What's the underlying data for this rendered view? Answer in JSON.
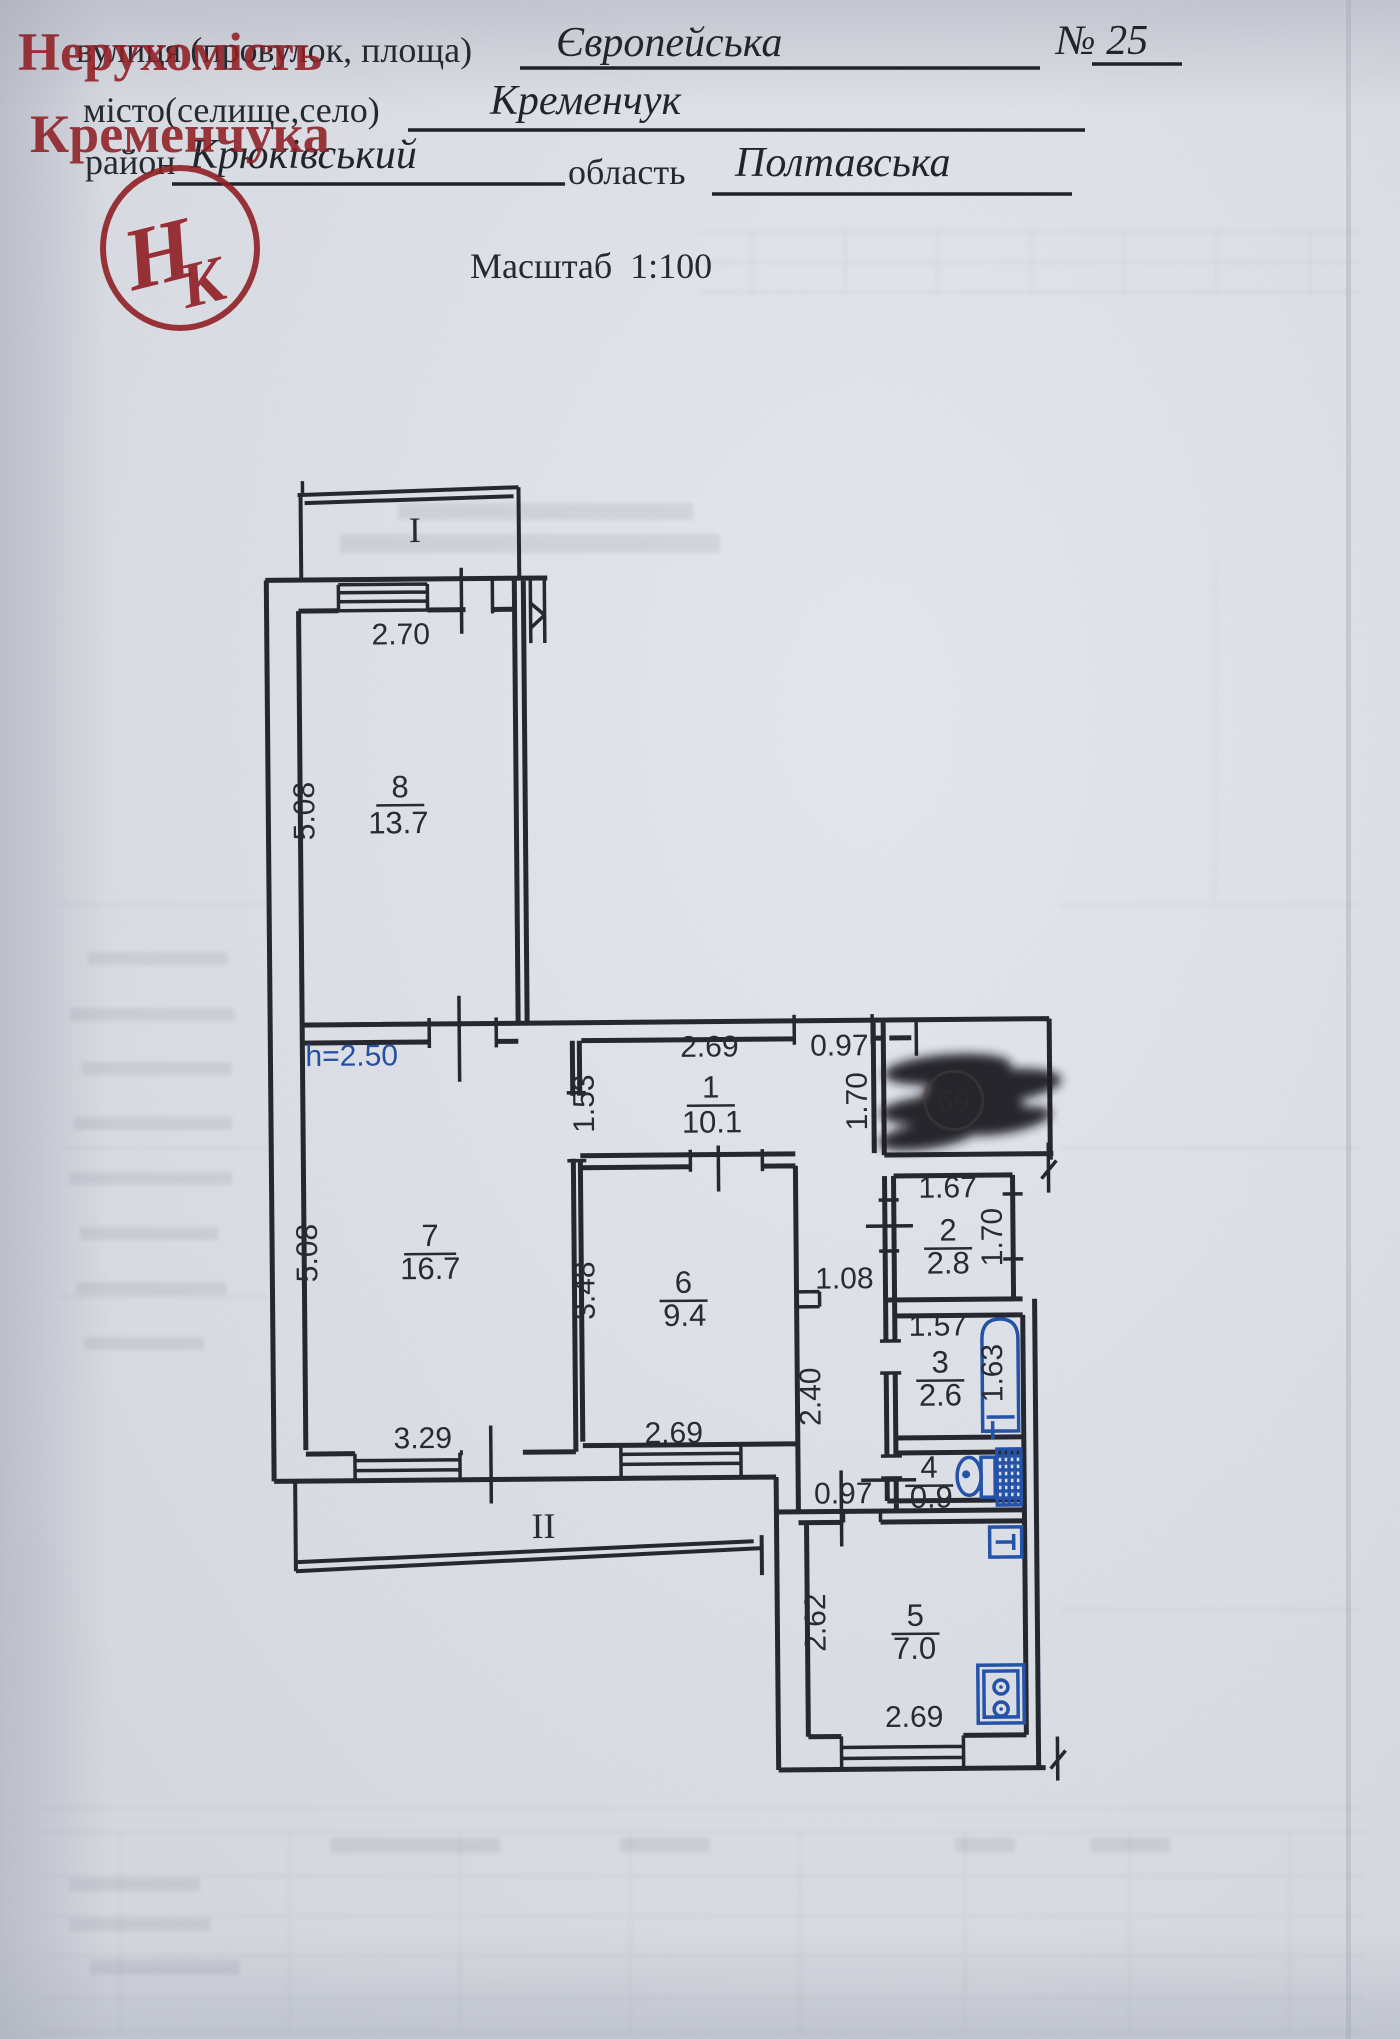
{
  "header": {
    "street_label": "вулиця (провулок, площа)",
    "street_value": "Європейська",
    "number_value": "№ 25",
    "city_label": "місто(селище,село)",
    "city_value": "Кременчук",
    "district_label": "район",
    "district_value": "Крюківський",
    "region_label": "область",
    "region_value": "Полтавська",
    "scale_text": "Масштаб  1:100"
  },
  "watermark": {
    "line1": "Нерухомість",
    "line2": "Кременчука",
    "monogram_h": "Н",
    "monogram_k": "К"
  },
  "plan": {
    "balcony_top": "I",
    "balcony_bottom": "II",
    "height_note": "h=2.50",
    "rooms": [
      {
        "num": "8",
        "area": "13.7"
      },
      {
        "num": "7",
        "area": "16.7"
      },
      {
        "num": "1",
        "area": "10.1"
      },
      {
        "num": "6",
        "area": "9.4"
      },
      {
        "num": "2",
        "area": "2.8"
      },
      {
        "num": "3",
        "area": "2.6"
      },
      {
        "num": "4",
        "area": "0.9"
      },
      {
        "num": "5",
        "area": "7.0"
      }
    ],
    "dims": {
      "room8_width": "2.70",
      "room8_height": "5.08",
      "room1_left": "1.53",
      "room1_width": "2.69",
      "entry_width": "0.97",
      "hall_height": "1.70",
      "room2_width": "1.67",
      "room2_height": "1.70",
      "room3_width": "1.57",
      "bath_length": "1.63",
      "wc_width": "0.97",
      "corridor_width": "1.08",
      "corridor_length": "2.40",
      "room6_height": "3.48",
      "room6_width": "2.69",
      "room7_height": "5.08",
      "room7_width": "3.29",
      "kitchen_height": "2.62",
      "kitchen_width": "2.69"
    }
  },
  "redaction": {
    "visible_number": "69"
  },
  "colors": {
    "stamp_red": "#8e1b20",
    "fixture_blue": "#2050a8",
    "ink": "#23232b"
  }
}
